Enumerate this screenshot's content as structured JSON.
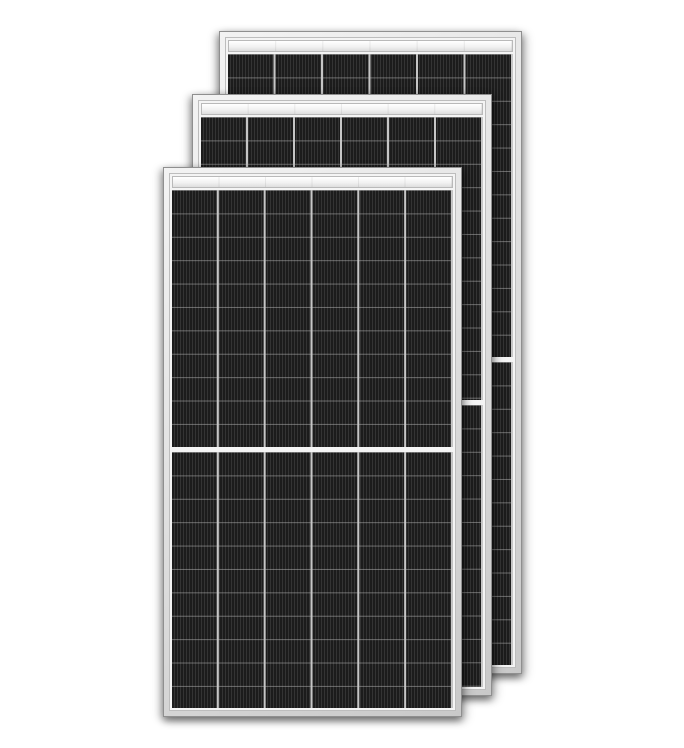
{
  "image": {
    "width": 684,
    "height": 748,
    "alt": "Three overlapping black half-cut solar photovoltaic modules with silver aluminium frames on a white background"
  },
  "panel_style": {
    "stage_background": "#ffffff",
    "frame_border": "#8f8f8f",
    "frame_fill_light": "#f3f3f3",
    "frame_fill_mid": "#dcdcdc",
    "frame_fill_dark": "#c9c9c9",
    "inner_margin": "#f4f4f4",
    "inner_border": "#bdbdbd",
    "header_top": "#ffffff",
    "header_mid": "#f2f2f2",
    "header_bottom": "#dedede",
    "header_border": "#b9b9b9",
    "cell_dark": "#1c1c1c",
    "cell_light": "#343434",
    "row_line": "rgba(185,185,185,0.5)",
    "column_line": "#c6c6c6",
    "columns": 6,
    "header_height_px": 12,
    "row_pitch_px": 23.4,
    "split_gap_px": 5
  },
  "panels": [
    {
      "id": "back",
      "left": 219,
      "top": 31,
      "width": 303,
      "height": 643,
      "z": 1
    },
    {
      "id": "middle",
      "left": 192,
      "top": 94,
      "width": 300,
      "height": 602,
      "z": 2
    },
    {
      "id": "front",
      "left": 163,
      "top": 167,
      "width": 299,
      "height": 550,
      "z": 3
    }
  ]
}
